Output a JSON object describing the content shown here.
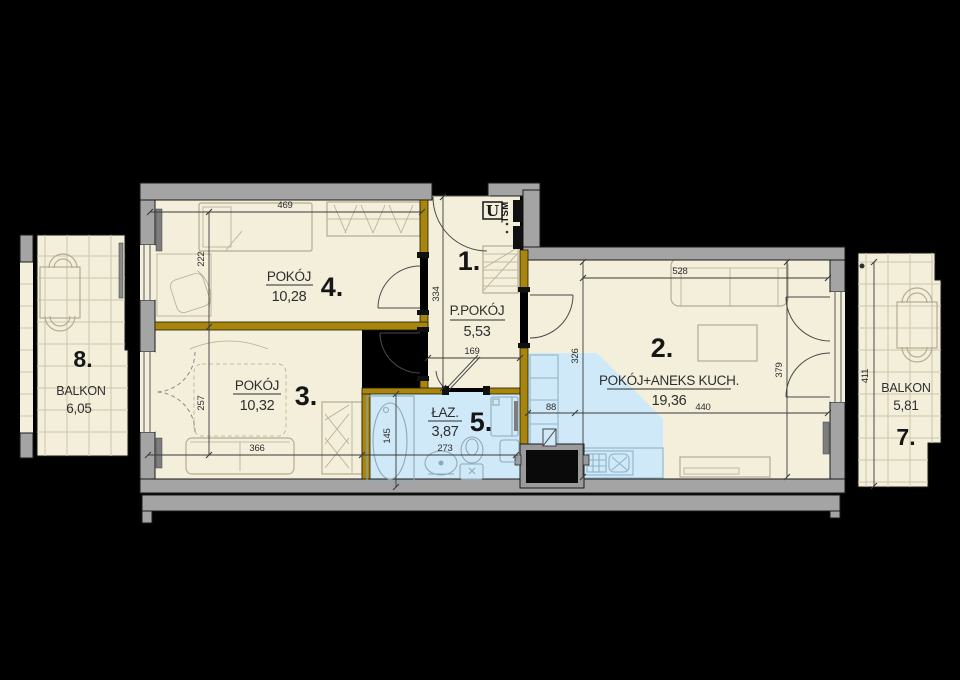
{
  "plan": {
    "rooms": {
      "hall": {
        "number": "1.",
        "name": "P.POKÓJ",
        "area": "5,53"
      },
      "living": {
        "number": "2.",
        "name": "POKÓJ+ANEKS KUCH.",
        "area": "19,36"
      },
      "room3": {
        "number": "3.",
        "name": "POKÓJ",
        "area": "10,32"
      },
      "room4": {
        "number": "4.",
        "name": "POKÓJ",
        "area": "10,28"
      },
      "bath": {
        "number": "5.",
        "name": "ŁAZ.",
        "area": "3,87"
      },
      "balcony7": {
        "number": "7.",
        "name": "BALKON",
        "area": "5,81"
      },
      "balcony8": {
        "number": "8.",
        "name": "BALKON",
        "area": "6,05"
      }
    },
    "annotations": {
      "meter": "U",
      "shaft": "TSM"
    },
    "dimensions": {
      "room4_width": "469",
      "room4_height": "222",
      "hall_height": "334",
      "hall_width": "169",
      "room3_height": "257",
      "room3_width": "366",
      "bath_height": "145",
      "bath_width": "273",
      "kitchen_offset": "88",
      "living_height_left": "326",
      "living_width": "440",
      "living_height_right": "379",
      "living_top_width": "528",
      "balcony7_height": "411"
    },
    "colors": {
      "background": "#000000",
      "wall": "#a4a4a4",
      "partition": "#a8860d",
      "floor": "#f3efdb",
      "wet": "#cfe9f8",
      "tile": "#ccc5a8",
      "furn": "#b5ac92",
      "fix": "#8fa9b8",
      "kit": "#8fb3c7",
      "dim": "#3a3a3a",
      "textc": "#2e2e2e"
    }
  }
}
